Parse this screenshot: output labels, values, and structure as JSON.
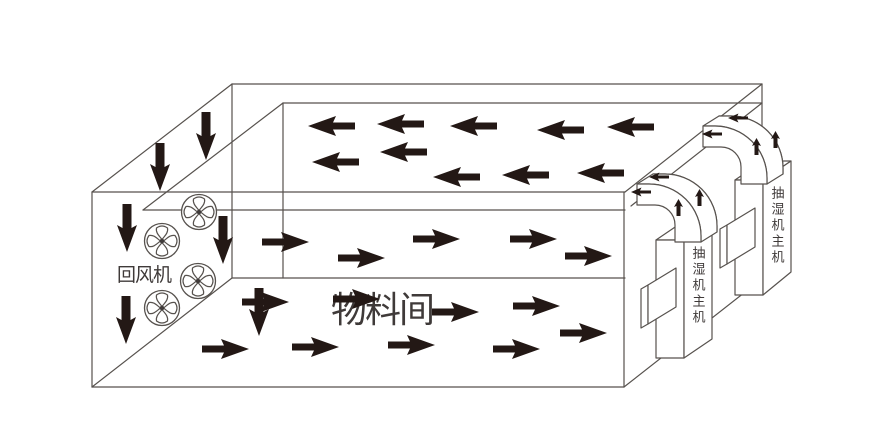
{
  "diagram": {
    "room": {
      "label": "物料间"
    },
    "return_fan": {
      "label": "回风机",
      "fan_count": 4
    },
    "dehumidifiers": [
      {
        "label": "抽湿机主机"
      },
      {
        "label": "抽湿机主机"
      }
    ],
    "airflow": {
      "ceiling_plenum": {
        "direction": "left",
        "arrow_count": 10
      },
      "material_room": {
        "direction": "right",
        "arrow_count": 9
      },
      "left_wall": {
        "direction": "down",
        "arrow_count": 6
      },
      "ducts": {
        "direction": "up-then-left",
        "arrows_per_duct": 4,
        "duct_count": 2
      }
    },
    "colors": {
      "background": "#ffffff",
      "arrow_ink": "#231815",
      "line": "#57524e",
      "label_text": "#3f3a39"
    },
    "icons": {
      "fan": "fan-icon",
      "airflow_left": "left-arrow-icon",
      "airflow_right": "right-arrow-icon",
      "airflow_down": "down-arrow-icon",
      "duct_up": "small-up-arrow-icon",
      "duct_left": "small-left-arrow-icon"
    }
  }
}
